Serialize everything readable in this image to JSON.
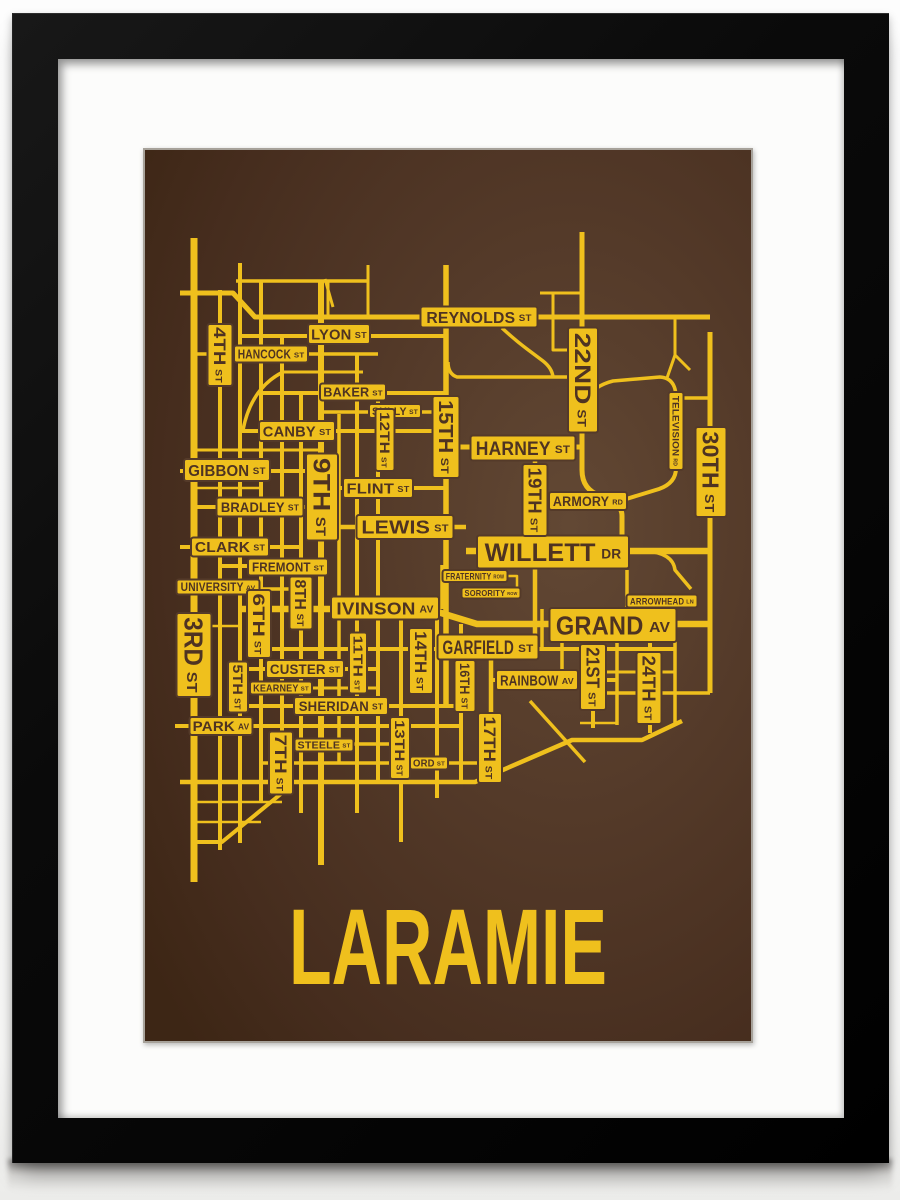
{
  "artwork": {
    "title": "LARAMIE",
    "type_note": "framed street map screen print",
    "colors": {
      "gold": "#efc01d",
      "ink": "#4e3322",
      "bg_light": "#624834",
      "bg_mid": "#543a29",
      "bg_dark": "#462d1e",
      "bg_edge": "#3d2615",
      "frame": "#0a0a0a",
      "mat": "#fcfcfb",
      "poster_edge": "#a7a29a"
    }
  },
  "map": {
    "roads": [
      {
        "n": "third-st",
        "d": "M49,88 V732",
        "w": 7
      },
      {
        "n": "fourth-st",
        "d": "M75,140 V700",
        "w": 4
      },
      {
        "n": "fifth-st",
        "d": "M95,113 V693",
        "w": 4
      },
      {
        "n": "sixth-st",
        "d": "M116,131 V652",
        "w": 4
      },
      {
        "n": "seventh-st",
        "d": "M137,187 V643 L77,692 H49",
        "w": 4
      },
      {
        "n": "eighth-st",
        "d": "M156,243 V663",
        "w": 4
      },
      {
        "n": "ninth-st",
        "d": "M176,131 V715",
        "w": 6
      },
      {
        "n": "tenth-st",
        "d": "M194,264 V614",
        "w": 3.5
      },
      {
        "n": "eleventh-st",
        "d": "M212,204 V663",
        "w": 4
      },
      {
        "n": "twelfth-st",
        "d": "M233,243 V634",
        "w": 4
      },
      {
        "n": "thirteenth-st",
        "d": "M256,459 V692",
        "w": 4
      },
      {
        "n": "fourteenth-st",
        "d": "M292,459 V648",
        "w": 4
      },
      {
        "n": "fifteenth-st",
        "d": "M301,115 V557",
        "w": 5.5
      },
      {
        "n": "sixteenth-st",
        "d": "M316,474 V632",
        "w": 4
      },
      {
        "n": "seventeenth-st",
        "d": "M346,499 V628",
        "w": 4.5
      },
      {
        "n": "nineteenth-st",
        "d": "M390,298 V498",
        "w": 4.5
      },
      {
        "n": "twentyfirst-st",
        "d": "M448,475 V578",
        "w": 4
      },
      {
        "n": "twentysecond-st",
        "d": "M437,82 V320 Q437,340 456,346 Q477,352 477,366 V401",
        "w": 5
      },
      {
        "n": "twentyfourth-st",
        "d": "M505,475 V583",
        "w": 4
      },
      {
        "n": "thirtieth-st",
        "d": "M565,182 V543",
        "w": 5
      },
      {
        "n": "reynolds-st",
        "d": "M35,143 H88 L110,167 H565",
        "w": 5
      },
      {
        "n": "lyon-st",
        "d": "M95,186 H301",
        "w": 4
      },
      {
        "n": "hancock-st",
        "d": "M49,204 H233",
        "w": 3.5
      },
      {
        "n": "baker-st",
        "d": "M116,243 H301",
        "w": 4
      },
      {
        "n": "sully-st",
        "d": "M176,262 H301",
        "w": 3.5
      },
      {
        "n": "canby-st",
        "d": "M95,281 H301",
        "w": 4
      },
      {
        "n": "gibbon-st",
        "d": "M35,321 H176",
        "w": 4
      },
      {
        "n": "flint-st",
        "d": "M176,338 H301",
        "w": 4
      },
      {
        "n": "bradley-st",
        "d": "M49,357 H176",
        "w": 4
      },
      {
        "n": "lewis-st",
        "d": "M176,377 H321",
        "w": 4.5
      },
      {
        "n": "clark-st",
        "d": "M35,397 H156",
        "w": 4
      },
      {
        "n": "fremont-st",
        "d": "M75,416 H176",
        "w": 4
      },
      {
        "n": "university-av",
        "d": "M33,439 H156",
        "w": 3.5
      },
      {
        "n": "ivinson-grand-av",
        "d": "M95,459 H283 L332,474 H565",
        "w": 6.5
      },
      {
        "n": "willett-dr",
        "d": "M321,401 H565",
        "w": 6.5
      },
      {
        "n": "harney-st",
        "d": "M301,297 H437",
        "w": 5
      },
      {
        "n": "armory-rd",
        "d": "M403,350 H477",
        "w": 3.5
      },
      {
        "n": "television-rd",
        "d": "M531,248 V318 Q531,333 514,339 L478,350",
        "w": 4
      },
      {
        "n": "television-north",
        "d": "M531,248 Q531,228 515,227 L468,231 Q448,236 441,250",
        "w": 3.5
      },
      {
        "n": "television-spur",
        "d": "M531,248 H565",
        "w": 3.5
      },
      {
        "n": "garfield-st",
        "d": "M116,499 H530",
        "w": 4
      },
      {
        "n": "custer-st",
        "d": "M95,519 H233",
        "w": 4
      },
      {
        "n": "kearney-st",
        "d": "M95,538 H233",
        "w": 3
      },
      {
        "n": "rainbow-av",
        "d": "M346,530 H472",
        "w": 4
      },
      {
        "n": "sheridan-st",
        "d": "M95,556 H321",
        "w": 4
      },
      {
        "n": "park-av",
        "d": "M30,576 H317",
        "w": 4
      },
      {
        "n": "steele-st",
        "d": "M125,594 H256",
        "w": 3.5
      },
      {
        "n": "ord-st",
        "d": "M116,613 H346",
        "w": 3.5
      },
      {
        "n": "south-boundary",
        "d": "M35,632 H330 L427,590 H497 L537,571",
        "w": 4.5
      },
      {
        "n": "south-diagonal",
        "d": "M385,551 L440,612",
        "w": 3.5
      },
      {
        "n": "row-top",
        "d": "M91,131 H223",
        "w": 3.5
      },
      {
        "n": "stub-lyon-north",
        "d": "M223,115 V167",
        "w": 3
      },
      {
        "n": "diag-lyon",
        "d": "M180,129 L188,157",
        "w": 3
      },
      {
        "n": "stub-183",
        "d": "M183,131 V167",
        "w": 3
      },
      {
        "n": "row-y222",
        "d": "M137,222 H218",
        "w": 3
      },
      {
        "n": "curve-4th",
        "d": "M138,222 Q106,238 98,280",
        "w": 3.5
      },
      {
        "n": "row-y300",
        "d": "M49,300 H176",
        "w": 3
      },
      {
        "n": "row-y338",
        "d": "M49,338 H116",
        "w": 2.5
      },
      {
        "n": "row-y476",
        "d": "M49,476 H95",
        "w": 2.5
      },
      {
        "n": "row-y652",
        "d": "M49,652 H137",
        "w": 2.5
      },
      {
        "n": "row-y672",
        "d": "M49,672 H116",
        "w": 2.5
      },
      {
        "n": "reynolds-curve",
        "d": "M357,178 Q370,190 382,199 L398,211 Q407,218 408,227",
        "w": 3.5
      },
      {
        "n": "row-y227",
        "d": "M303,212 Q303,224 312,227 H437",
        "w": 3.5
      },
      {
        "n": "stub-y143",
        "d": "M408,143 V200 H437",
        "w": 3
      },
      {
        "n": "row-y143",
        "d": "M395,143 H437",
        "w": 3
      },
      {
        "n": "ne-stub",
        "d": "M530,168 V205",
        "w": 3
      },
      {
        "n": "ne-fork-a",
        "d": "M530,205 L545,220",
        "w": 3
      },
      {
        "n": "ne-fork-b",
        "d": "M530,205 L522,228",
        "w": 3
      },
      {
        "n": "fraternity-vert",
        "d": "M297,415 V459",
        "w": 3.5
      },
      {
        "n": "fraternity-conn",
        "d": "M362,426 H372 V443 H375",
        "w": 2.5
      },
      {
        "n": "campus-vert-397",
        "d": "M397,459 V499",
        "w": 3.5
      },
      {
        "n": "campus-vert-417",
        "d": "M417,475 V531",
        "w": 3.5
      },
      {
        "n": "arrowhead-vert",
        "d": "M482,420 V459",
        "w": 3.5
      },
      {
        "n": "arrowhead-ln",
        "d": "M501,401 Q528,403 530,420 L546,439",
        "w": 3.5
      },
      {
        "n": "grand-y522",
        "d": "M435,522 H530",
        "w": 3
      },
      {
        "n": "grand-y543",
        "d": "M460,543 H565",
        "w": 3.5
      },
      {
        "n": "grand-y573",
        "d": "M435,573 H472",
        "w": 2.5
      },
      {
        "n": "mid-vert-472",
        "d": "M472,475 V575",
        "w": 3.5
      },
      {
        "n": "mid-vert-530",
        "d": "M530,475 V574",
        "w": 3.5
      }
    ],
    "labels": [
      {
        "t": "REYNOLDS",
        "s": "ST",
        "x": 334,
        "y": 167,
        "w": 117,
        "h": 21,
        "f": 16,
        "o": "h"
      },
      {
        "t": "LYON",
        "s": "ST",
        "x": 194,
        "y": 184,
        "w": 62,
        "h": 20,
        "f": 15,
        "o": "h"
      },
      {
        "t": "HANCOCK",
        "s": "ST",
        "x": 126,
        "y": 204,
        "w": 74,
        "h": 17,
        "f": 13,
        "o": "h"
      },
      {
        "t": "BAKER",
        "s": "ST",
        "x": 208,
        "y": 242,
        "w": 66,
        "h": 17,
        "f": 13,
        "o": "h"
      },
      {
        "t": "SULLY",
        "s": "ST",
        "x": 250,
        "y": 261,
        "w": 52,
        "h": 14,
        "f": 11,
        "o": "h"
      },
      {
        "t": "CANBY",
        "s": "ST",
        "x": 152,
        "y": 281,
        "w": 76,
        "h": 20,
        "f": 15,
        "o": "h"
      },
      {
        "t": "HARNEY",
        "s": "ST",
        "x": 378,
        "y": 298,
        "w": 105,
        "h": 25,
        "f": 19,
        "o": "h"
      },
      {
        "t": "GIBBON",
        "s": "ST",
        "x": 82,
        "y": 320,
        "w": 86,
        "h": 22,
        "f": 16,
        "o": "h"
      },
      {
        "t": "FLINT",
        "s": "ST",
        "x": 233,
        "y": 338,
        "w": 70,
        "h": 20,
        "f": 15,
        "o": "h"
      },
      {
        "t": "BRADLEY",
        "s": "ST",
        "x": 115,
        "y": 357,
        "w": 87,
        "h": 19,
        "f": 14,
        "o": "h"
      },
      {
        "t": "LEWIS",
        "s": "ST",
        "x": 260,
        "y": 377,
        "w": 97,
        "h": 24,
        "f": 18,
        "o": "h"
      },
      {
        "t": "CLARK",
        "s": "ST",
        "x": 85,
        "y": 397,
        "w": 78,
        "h": 19,
        "f": 14.5,
        "o": "h"
      },
      {
        "t": "FREMONT",
        "s": "ST",
        "x": 143,
        "y": 417,
        "w": 80,
        "h": 17,
        "f": 13,
        "o": "h"
      },
      {
        "t": "UNIVERSITY",
        "s": "AV",
        "x": 73,
        "y": 437,
        "w": 83,
        "h": 15,
        "f": 11.5,
        "o": "h"
      },
      {
        "t": "IVINSON",
        "s": "AV",
        "x": 240,
        "y": 458,
        "w": 108,
        "h": 23,
        "f": 17.5,
        "o": "h"
      },
      {
        "t": "ARMORY",
        "s": "RD",
        "x": 443,
        "y": 351,
        "w": 78,
        "h": 18,
        "f": 13.5,
        "o": "h"
      },
      {
        "t": "WILLETT",
        "s": "DR",
        "x": 408,
        "y": 402,
        "w": 152,
        "h": 33,
        "f": 25,
        "o": "h"
      },
      {
        "t": "FRATERNITY",
        "s": "ROW",
        "x": 330,
        "y": 426,
        "w": 65,
        "h": 12,
        "f": 9,
        "o": "h"
      },
      {
        "t": "SORORITY",
        "s": "ROW",
        "x": 346,
        "y": 443,
        "w": 59,
        "h": 11,
        "f": 8.5,
        "o": "h"
      },
      {
        "t": "ARROWHEAD",
        "s": "LN",
        "x": 517,
        "y": 451,
        "w": 71,
        "h": 13,
        "f": 9.5,
        "o": "h"
      },
      {
        "t": "GRAND",
        "s": "AV",
        "x": 468,
        "y": 475,
        "w": 127,
        "h": 34,
        "f": 26,
        "o": "h"
      },
      {
        "t": "GARFIELD",
        "s": "ST",
        "x": 343,
        "y": 497,
        "w": 101,
        "h": 25,
        "f": 19,
        "o": "h"
      },
      {
        "t": "RAINBOW",
        "s": "AV",
        "x": 392,
        "y": 530,
        "w": 82,
        "h": 20,
        "f": 15,
        "o": "h"
      },
      {
        "t": "CUSTER",
        "s": "ST",
        "x": 160,
        "y": 519,
        "w": 78,
        "h": 18,
        "f": 14,
        "o": "h"
      },
      {
        "t": "KEARNEY",
        "s": "ST",
        "x": 136,
        "y": 538,
        "w": 62,
        "h": 13,
        "f": 10,
        "o": "h"
      },
      {
        "t": "SHERIDAN",
        "s": "ST",
        "x": 196,
        "y": 556,
        "w": 94,
        "h": 18,
        "f": 14,
        "o": "h"
      },
      {
        "t": "PARK",
        "s": "AV",
        "x": 76,
        "y": 576,
        "w": 63,
        "h": 18,
        "f": 14,
        "o": "h"
      },
      {
        "t": "STEELE",
        "s": "ST",
        "x": 179,
        "y": 595,
        "w": 59,
        "h": 13,
        "f": 10,
        "o": "h"
      },
      {
        "t": "ORD",
        "s": "ST",
        "x": 284,
        "y": 613,
        "w": 38,
        "h": 13,
        "f": 10,
        "o": "h"
      },
      {
        "t": "3RD",
        "s": "ST",
        "x": 49,
        "y": 505,
        "w": 84,
        "h": 35,
        "f": 26,
        "o": "v"
      },
      {
        "t": "4TH",
        "s": "ST",
        "x": 75,
        "y": 205,
        "w": 62,
        "h": 25,
        "f": 17,
        "o": "v"
      },
      {
        "t": "5TH",
        "s": "ST",
        "x": 93,
        "y": 537,
        "w": 51,
        "h": 20,
        "f": 14,
        "o": "v"
      },
      {
        "t": "6TH",
        "s": "ST",
        "x": 114,
        "y": 474,
        "w": 68,
        "h": 24,
        "f": 17,
        "o": "v"
      },
      {
        "t": "7TH",
        "s": "ST",
        "x": 136,
        "y": 613,
        "w": 63,
        "h": 24,
        "f": 17,
        "o": "v"
      },
      {
        "t": "8TH",
        "s": "ST",
        "x": 156,
        "y": 453,
        "w": 53,
        "h": 23,
        "f": 16,
        "o": "v"
      },
      {
        "t": "9TH",
        "s": "ST",
        "x": 177,
        "y": 347,
        "w": 87,
        "h": 32,
        "f": 24,
        "o": "v"
      },
      {
        "t": "11TH",
        "s": "ST",
        "x": 213,
        "y": 513,
        "w": 61,
        "h": 18,
        "f": 13,
        "o": "v"
      },
      {
        "t": "12TH",
        "s": "ST",
        "x": 240,
        "y": 290,
        "w": 62,
        "h": 19,
        "f": 13.5,
        "o": "v"
      },
      {
        "t": "13TH",
        "s": "ST",
        "x": 255,
        "y": 598,
        "w": 62,
        "h": 20,
        "f": 14,
        "o": "v"
      },
      {
        "t": "14TH",
        "s": "ST",
        "x": 276,
        "y": 511,
        "w": 66,
        "h": 24,
        "f": 17,
        "o": "v"
      },
      {
        "t": "15TH",
        "s": "ST",
        "x": 301,
        "y": 287,
        "w": 82,
        "h": 27,
        "f": 20,
        "o": "v"
      },
      {
        "t": "16TH",
        "s": "ST",
        "x": 320,
        "y": 536,
        "w": 52,
        "h": 21,
        "f": 14,
        "o": "v"
      },
      {
        "t": "17TH",
        "s": "ST",
        "x": 345,
        "y": 598,
        "w": 70,
        "h": 24,
        "f": 17,
        "o": "v"
      },
      {
        "t": "19TH",
        "s": "ST",
        "x": 390,
        "y": 350,
        "w": 72,
        "h": 25,
        "f": 18,
        "o": "v"
      },
      {
        "t": "21ST",
        "s": "ST",
        "x": 448,
        "y": 527,
        "w": 66,
        "h": 26,
        "f": 18,
        "o": "v"
      },
      {
        "t": "22ND",
        "s": "ST",
        "x": 438,
        "y": 230,
        "w": 105,
        "h": 30,
        "f": 22,
        "o": "v"
      },
      {
        "t": "24TH",
        "s": "ST",
        "x": 504,
        "y": 538,
        "w": 72,
        "h": 25,
        "f": 18,
        "o": "v"
      },
      {
        "t": "30TH",
        "s": "ST",
        "x": 566,
        "y": 322,
        "w": 90,
        "h": 31,
        "f": 23,
        "o": "v"
      },
      {
        "t": "TELEVISION",
        "s": "RD",
        "x": 531,
        "y": 281,
        "w": 78,
        "h": 15,
        "f": 9.5,
        "o": "v"
      }
    ]
  }
}
